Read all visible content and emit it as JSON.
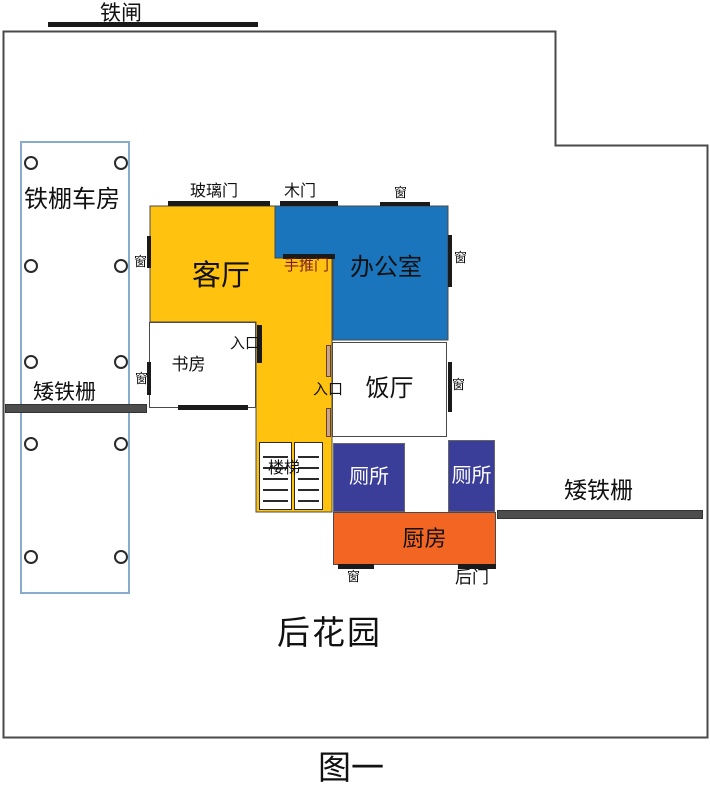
{
  "title": "住宅平面图",
  "captions": {
    "garden": "后花园",
    "figure": "图一"
  },
  "gate": {
    "label": "铁闸"
  },
  "garage": {
    "label": "铁棚车房",
    "post_count": 10
  },
  "fences": {
    "left_label": "矮铁栅",
    "right_label": "矮铁栅"
  },
  "rooms": {
    "living": {
      "label": "客厅",
      "color": "#ffc20e"
    },
    "office": {
      "label": "办公室",
      "color": "#1b75bc"
    },
    "study": {
      "label": "书房",
      "color": "#ffffff"
    },
    "dining": {
      "label": "饭厅",
      "color": "#ffffff"
    },
    "toilet_left": {
      "label": "厕所",
      "color": "#3b3e99"
    },
    "toilet_right": {
      "label": "厕所",
      "color": "#3b3e99"
    },
    "kitchen": {
      "label": "厨房",
      "color": "#f26522"
    },
    "stairs": {
      "label": "楼梯"
    }
  },
  "doors": {
    "glass": "玻璃门",
    "wood": "木门",
    "push": "手推门",
    "entrance_study": "入口",
    "entrance_dining": "入口",
    "back": "后门"
  },
  "windows": {
    "office_top": "窗",
    "office_right": "窗",
    "dining_right": "窗",
    "left_wall_upper": "窗",
    "left_wall_lower": "窗",
    "kitchen_bottom": "窗"
  },
  "colors": {
    "wall": "#4a4a4a",
    "door_bar": "#1a1a1a",
    "fence_bar": "#4d4d4d",
    "garage_border": "#8aaccc",
    "push_door_text": "#7a1f1f"
  }
}
